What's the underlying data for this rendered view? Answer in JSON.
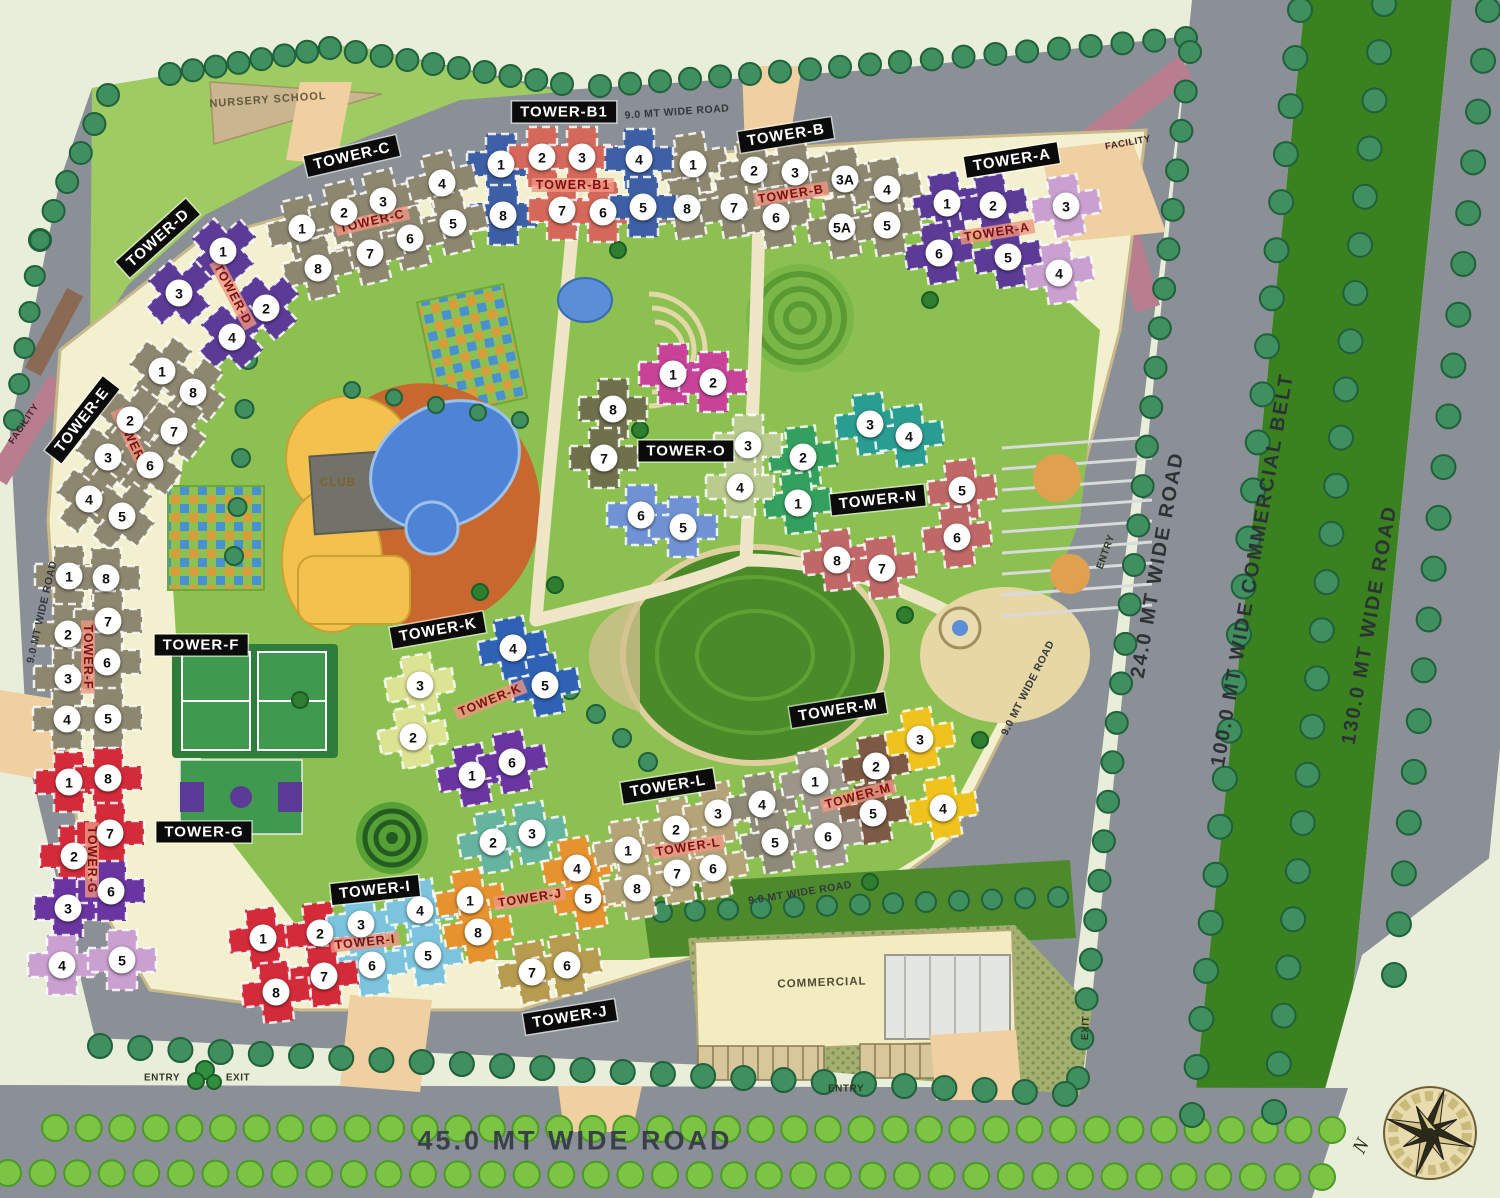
{
  "map_title": "Township Site Plan",
  "compass": {
    "north_label": "N"
  },
  "colors": {
    "road": "#8b9097",
    "site_green": "#8cc152",
    "compound": "#f2f0cf",
    "belt_green": "#3a821f",
    "tower_label_bg": "#0b0b0b",
    "tower_label_red": "#7e1010",
    "pool_blue": "#4f83d6",
    "club_yellow": "#f2c14e",
    "deck_orange": "#c8682e"
  },
  "roads": [
    {
      "id": "top-9mt",
      "label": "9.0 MT WIDE ROAD",
      "x": 677,
      "y": 112,
      "rot": -4,
      "v": "road-small"
    },
    {
      "id": "left-9mt",
      "label": "9.0 MT WIDE ROAD",
      "x": 42,
      "y": 612,
      "rot": -77,
      "v": "road-small"
    },
    {
      "id": "right-9mt",
      "label": "9.0 MT WIDE ROAD",
      "x": 1028,
      "y": 688,
      "rot": -63,
      "v": "road-small"
    },
    {
      "id": "bottom-9mt",
      "label": "9.0 MT WIDE ROAD",
      "x": 800,
      "y": 893,
      "rot": -9,
      "v": "road-small"
    },
    {
      "id": "24mt",
      "label": "24.0 MT WIDE ROAD",
      "x": 1158,
      "y": 565,
      "rot": -80,
      "v": "road-big"
    },
    {
      "id": "100mt-belt",
      "label": "100.0 MT WIDE COMMERCIAL BELT",
      "x": 1253,
      "y": 570,
      "rot": -80,
      "v": "road-big"
    },
    {
      "id": "130mt",
      "label": "130.0 MT WIDE ROAD",
      "x": 1370,
      "y": 625,
      "rot": -80,
      "v": "road-big"
    },
    {
      "id": "45mt",
      "label": "45.0 MT WIDE ROAD",
      "x": 575,
      "y": 1141,
      "rot": 0,
      "v": "road-huge"
    }
  ],
  "areas": [
    {
      "id": "nursery-school",
      "label": "NURSERY SCHOOL",
      "x": 268,
      "y": 100,
      "rot": -4,
      "v": "nursery"
    },
    {
      "id": "club",
      "label": "CLUB",
      "x": 338,
      "y": 483,
      "rot": 0,
      "v": "club"
    },
    {
      "id": "commercial",
      "label": "COMMERCIAL",
      "x": 822,
      "y": 983,
      "rot": -2,
      "v": "commercial"
    },
    {
      "id": "facility-top",
      "label": "FACILITY",
      "x": 1128,
      "y": 143,
      "rot": -10,
      "v": "facility"
    },
    {
      "id": "facility-left",
      "label": "FACILITY",
      "x": 24,
      "y": 424,
      "rot": -56,
      "v": "facility"
    },
    {
      "id": "entry-bottom-left",
      "label": "ENTRY",
      "x": 162,
      "y": 1078,
      "rot": 0,
      "v": "entry"
    },
    {
      "id": "exit-bottom-left",
      "label": "EXIT",
      "x": 238,
      "y": 1078,
      "rot": 0,
      "v": "entry"
    },
    {
      "id": "entry-bottom",
      "label": "ENTRY",
      "x": 846,
      "y": 1089,
      "rot": 0,
      "v": "entry"
    },
    {
      "id": "exit-right",
      "label": "EXIT",
      "x": 1086,
      "y": 1028,
      "rot": -87,
      "v": "entry"
    },
    {
      "id": "entry-right",
      "label": "ENTRY",
      "x": 1106,
      "y": 552,
      "rot": -70,
      "v": "entry"
    }
  ],
  "towers": [
    {
      "name": "TOWER-A",
      "bx": 1012,
      "by": 160,
      "brot": -9,
      "rx": 997,
      "ry": 232,
      "rrot": -9,
      "units": [
        {
          "n": "1",
          "x": 947,
          "y": 203,
          "c": "#5c3b97"
        },
        {
          "n": "2",
          "x": 993,
          "y": 205,
          "c": "#5c3b97"
        },
        {
          "n": "3",
          "x": 1066,
          "y": 206,
          "c": "#c9a0d0"
        },
        {
          "n": "6",
          "x": 939,
          "y": 253,
          "c": "#5c3b97"
        },
        {
          "n": "5",
          "x": 1008,
          "y": 257,
          "c": "#5c3b97"
        },
        {
          "n": "4",
          "x": 1059,
          "y": 273,
          "c": "#c9a0d0"
        }
      ]
    },
    {
      "name": "TOWER-B",
      "bx": 786,
      "by": 135,
      "brot": -9,
      "rx": 791,
      "ry": 194,
      "rrot": -9,
      "units": [
        {
          "n": "1",
          "x": 693,
          "y": 164,
          "c": "#8d8770"
        },
        {
          "n": "2",
          "x": 754,
          "y": 170,
          "c": "#8d8770"
        },
        {
          "n": "3",
          "x": 795,
          "y": 172,
          "c": "#8d8770"
        },
        {
          "n": "3A",
          "x": 845,
          "y": 179,
          "c": "#8d8770"
        },
        {
          "n": "4",
          "x": 887,
          "y": 189,
          "c": "#8d8770"
        },
        {
          "n": "8",
          "x": 687,
          "y": 208,
          "c": "#8d8770"
        },
        {
          "n": "7",
          "x": 734,
          "y": 207,
          "c": "#8d8770"
        },
        {
          "n": "6",
          "x": 776,
          "y": 217,
          "c": "#8d8770"
        },
        {
          "n": "5A",
          "x": 842,
          "y": 227,
          "c": "#8d8770"
        },
        {
          "n": "5",
          "x": 887,
          "y": 225,
          "c": "#8d8770"
        }
      ]
    },
    {
      "name": "TOWER-B1",
      "bx": 564,
      "by": 112,
      "brot": 0,
      "rx": 573,
      "ry": 185,
      "rrot": 0,
      "units": [
        {
          "n": "1",
          "x": 501,
          "y": 164,
          "c": "#3d5fa5"
        },
        {
          "n": "2",
          "x": 542,
          "y": 157,
          "c": "#d4685a"
        },
        {
          "n": "3",
          "x": 582,
          "y": 157,
          "c": "#d4685a"
        },
        {
          "n": "4",
          "x": 639,
          "y": 159,
          "c": "#3d5fa5"
        },
        {
          "n": "8",
          "x": 503,
          "y": 215,
          "c": "#3d5fa5"
        },
        {
          "n": "7",
          "x": 562,
          "y": 210,
          "c": "#d4685a"
        },
        {
          "n": "6",
          "x": 603,
          "y": 212,
          "c": "#d4685a"
        },
        {
          "n": "5",
          "x": 643,
          "y": 207,
          "c": "#3d5fa5"
        }
      ]
    },
    {
      "name": "TOWER-C",
      "bx": 352,
      "by": 156,
      "brot": -13,
      "rx": 372,
      "ry": 221,
      "rrot": -13,
      "units": [
        {
          "n": "1",
          "x": 302,
          "y": 228,
          "c": "#8d8770"
        },
        {
          "n": "2",
          "x": 344,
          "y": 212,
          "c": "#8d8770"
        },
        {
          "n": "3",
          "x": 383,
          "y": 201,
          "c": "#8d8770"
        },
        {
          "n": "4",
          "x": 442,
          "y": 183,
          "c": "#8d8770"
        },
        {
          "n": "5",
          "x": 453,
          "y": 223,
          "c": "#8d8770"
        },
        {
          "n": "6",
          "x": 410,
          "y": 238,
          "c": "#8d8770"
        },
        {
          "n": "7",
          "x": 370,
          "y": 253,
          "c": "#8d8770"
        },
        {
          "n": "8",
          "x": 318,
          "y": 268,
          "c": "#8d8770"
        }
      ]
    },
    {
      "name": "TOWER-D",
      "bx": 158,
      "by": 238,
      "brot": -42,
      "rx": 233,
      "ry": 294,
      "rrot": 62,
      "units": [
        {
          "n": "1",
          "x": 223,
          "y": 251,
          "c": "#5c3b97"
        },
        {
          "n": "3",
          "x": 179,
          "y": 293,
          "c": "#5c3b97"
        },
        {
          "n": "2",
          "x": 266,
          "y": 308,
          "c": "#5c3b97"
        },
        {
          "n": "4",
          "x": 232,
          "y": 337,
          "c": "#5c3b97"
        }
      ]
    },
    {
      "name": "TOWER-E",
      "bx": 82,
      "by": 420,
      "brot": -52,
      "rx": 133,
      "ry": 443,
      "rrot": 64,
      "units": [
        {
          "n": "1",
          "x": 162,
          "y": 371,
          "c": "#8d8770"
        },
        {
          "n": "8",
          "x": 193,
          "y": 392,
          "c": "#8d8770"
        },
        {
          "n": "2",
          "x": 130,
          "y": 420,
          "c": "#8d8770"
        },
        {
          "n": "7",
          "x": 174,
          "y": 431,
          "c": "#8d8770"
        },
        {
          "n": "3",
          "x": 108,
          "y": 457,
          "c": "#8d8770"
        },
        {
          "n": "6",
          "x": 150,
          "y": 465,
          "c": "#8d8770"
        },
        {
          "n": "4",
          "x": 89,
          "y": 499,
          "c": "#8d8770"
        },
        {
          "n": "5",
          "x": 122,
          "y": 516,
          "c": "#8d8770"
        }
      ]
    },
    {
      "name": "TOWER-F",
      "bx": 201,
      "by": 645,
      "brot": 0,
      "rx": 88,
      "ry": 657,
      "rrot": 90,
      "units": [
        {
          "n": "1",
          "x": 69,
          "y": 576,
          "c": "#8d8770"
        },
        {
          "n": "8",
          "x": 106,
          "y": 578,
          "c": "#8d8770"
        },
        {
          "n": "2",
          "x": 68,
          "y": 634,
          "c": "#8d8770"
        },
        {
          "n": "7",
          "x": 108,
          "y": 621,
          "c": "#8d8770"
        },
        {
          "n": "3",
          "x": 68,
          "y": 678,
          "c": "#8d8770"
        },
        {
          "n": "6",
          "x": 107,
          "y": 662,
          "c": "#8d8770"
        },
        {
          "n": "4",
          "x": 67,
          "y": 719,
          "c": "#8d8770"
        },
        {
          "n": "5",
          "x": 108,
          "y": 718,
          "c": "#8d8770"
        }
      ]
    },
    {
      "name": "TOWER-G",
      "bx": 204,
      "by": 832,
      "brot": 0,
      "rx": 92,
      "ry": 860,
      "rrot": 90,
      "units": [
        {
          "n": "1",
          "x": 69,
          "y": 782,
          "c": "#d42b3a"
        },
        {
          "n": "8",
          "x": 108,
          "y": 778,
          "c": "#d42b3a"
        },
        {
          "n": "2",
          "x": 74,
          "y": 856,
          "c": "#d42b3a"
        },
        {
          "n": "7",
          "x": 110,
          "y": 833,
          "c": "#d42b3a"
        },
        {
          "n": "3",
          "x": 68,
          "y": 908,
          "c": "#6a35a0"
        },
        {
          "n": "6",
          "x": 111,
          "y": 891,
          "c": "#6a35a0"
        },
        {
          "n": "4",
          "x": 62,
          "y": 965,
          "c": "#c9a0d0"
        },
        {
          "n": "5",
          "x": 122,
          "y": 960,
          "c": "#c9a0d0"
        }
      ]
    },
    {
      "name": "TOWER-I",
      "bx": 375,
      "by": 890,
      "brot": -6,
      "rx": 365,
      "ry": 942,
      "rrot": -6,
      "units": [
        {
          "n": "1",
          "x": 263,
          "y": 938,
          "c": "#d42b3a"
        },
        {
          "n": "2",
          "x": 320,
          "y": 933,
          "c": "#d42b3a"
        },
        {
          "n": "3",
          "x": 361,
          "y": 924,
          "c": "#7cc4dd"
        },
        {
          "n": "4",
          "x": 420,
          "y": 910,
          "c": "#7cc4dd"
        },
        {
          "n": "5",
          "x": 428,
          "y": 955,
          "c": "#7cc4dd"
        },
        {
          "n": "6",
          "x": 372,
          "y": 965,
          "c": "#7cc4dd"
        },
        {
          "n": "7",
          "x": 324,
          "y": 976,
          "c": "#d42b3a"
        },
        {
          "n": "8",
          "x": 276,
          "y": 992,
          "c": "#d42b3a"
        }
      ]
    },
    {
      "name": "TOWER-J",
      "bx": 570,
      "by": 1017,
      "brot": -9,
      "rx": 530,
      "ry": 898,
      "rrot": -9,
      "units": [
        {
          "n": "2",
          "x": 493,
          "y": 842,
          "c": "#64b4a0"
        },
        {
          "n": "3",
          "x": 532,
          "y": 833,
          "c": "#64b4a0"
        },
        {
          "n": "1",
          "x": 470,
          "y": 900,
          "c": "#e6922e"
        },
        {
          "n": "4",
          "x": 577,
          "y": 868,
          "c": "#e6922e"
        },
        {
          "n": "5",
          "x": 588,
          "y": 898,
          "c": "#e6922e"
        },
        {
          "n": "8",
          "x": 478,
          "y": 932,
          "c": "#e6922e"
        },
        {
          "n": "7",
          "x": 532,
          "y": 972,
          "c": "#b79b4e"
        },
        {
          "n": "6",
          "x": 567,
          "y": 965,
          "c": "#b79b4e"
        }
      ]
    },
    {
      "name": "TOWER-K",
      "bx": 438,
      "by": 630,
      "brot": -10,
      "rx": 490,
      "ry": 700,
      "rrot": -22,
      "units": [
        {
          "n": "3",
          "x": 420,
          "y": 685,
          "c": "#dce393"
        },
        {
          "n": "2",
          "x": 413,
          "y": 737,
          "c": "#dce393"
        },
        {
          "n": "4",
          "x": 513,
          "y": 648,
          "c": "#2f62b4"
        },
        {
          "n": "5",
          "x": 545,
          "y": 685,
          "c": "#2f62b4"
        },
        {
          "n": "1",
          "x": 472,
          "y": 775,
          "c": "#6a35a0"
        },
        {
          "n": "6",
          "x": 512,
          "y": 762,
          "c": "#6a35a0"
        }
      ]
    },
    {
      "name": "TOWER-L",
      "bx": 668,
      "by": 786,
      "brot": -9,
      "rx": 688,
      "ry": 847,
      "rrot": -9,
      "units": [
        {
          "n": "1",
          "x": 628,
          "y": 850,
          "c": "#b4a478"
        },
        {
          "n": "2",
          "x": 676,
          "y": 829,
          "c": "#b4a478"
        },
        {
          "n": "3",
          "x": 718,
          "y": 813,
          "c": "#b4a478"
        },
        {
          "n": "4",
          "x": 762,
          "y": 804,
          "c": "#8f8a78"
        },
        {
          "n": "5",
          "x": 775,
          "y": 842,
          "c": "#8f8a78"
        },
        {
          "n": "6",
          "x": 713,
          "y": 868,
          "c": "#b4a478"
        },
        {
          "n": "7",
          "x": 677,
          "y": 873,
          "c": "#b4a478"
        },
        {
          "n": "8",
          "x": 637,
          "y": 888,
          "c": "#b4a478"
        }
      ]
    },
    {
      "name": "TOWER-M",
      "bx": 838,
      "by": 710,
      "brot": -9,
      "rx": 858,
      "ry": 796,
      "rrot": -15,
      "units": [
        {
          "n": "1",
          "x": 815,
          "y": 781,
          "c": "#9c968a"
        },
        {
          "n": "2",
          "x": 876,
          "y": 766,
          "c": "#7c5a44"
        },
        {
          "n": "3",
          "x": 920,
          "y": 739,
          "c": "#f0c21e"
        },
        {
          "n": "4",
          "x": 943,
          "y": 808,
          "c": "#f0c21e"
        },
        {
          "n": "5",
          "x": 873,
          "y": 813,
          "c": "#7c5a44"
        },
        {
          "n": "6",
          "x": 828,
          "y": 836,
          "c": "#9c968a"
        }
      ]
    },
    {
      "name": "TOWER-N",
      "bx": 878,
      "by": 500,
      "brot": -6,
      "units": [
        {
          "n": "2",
          "x": 803,
          "y": 457,
          "c": "#33a05f"
        },
        {
          "n": "1",
          "x": 798,
          "y": 503,
          "c": "#33a05f"
        },
        {
          "n": "3",
          "x": 870,
          "y": 424,
          "c": "#2a9d93"
        },
        {
          "n": "4",
          "x": 909,
          "y": 436,
          "c": "#2a9d93"
        },
        {
          "n": "5",
          "x": 962,
          "y": 490,
          "c": "#c06868"
        },
        {
          "n": "6",
          "x": 957,
          "y": 537,
          "c": "#c06868"
        },
        {
          "n": "8",
          "x": 837,
          "y": 560,
          "c": "#c06868"
        },
        {
          "n": "7",
          "x": 882,
          "y": 568,
          "c": "#c06868"
        }
      ]
    },
    {
      "name": "TOWER-O",
      "bx": 686,
      "by": 451,
      "brot": 0,
      "units": [
        {
          "n": "1",
          "x": 673,
          "y": 374,
          "c": "#c84398"
        },
        {
          "n": "2",
          "x": 713,
          "y": 382,
          "c": "#c84398"
        },
        {
          "n": "8",
          "x": 613,
          "y": 409,
          "c": "#70704c"
        },
        {
          "n": "7",
          "x": 604,
          "y": 458,
          "c": "#70704c"
        },
        {
          "n": "3",
          "x": 748,
          "y": 445,
          "c": "#b9cc8e"
        },
        {
          "n": "4",
          "x": 740,
          "y": 487,
          "c": "#b9cc8e"
        },
        {
          "n": "6",
          "x": 641,
          "y": 515,
          "c": "#6f92d4"
        },
        {
          "n": "5",
          "x": 683,
          "y": 527,
          "c": "#6f92d4"
        }
      ]
    }
  ]
}
